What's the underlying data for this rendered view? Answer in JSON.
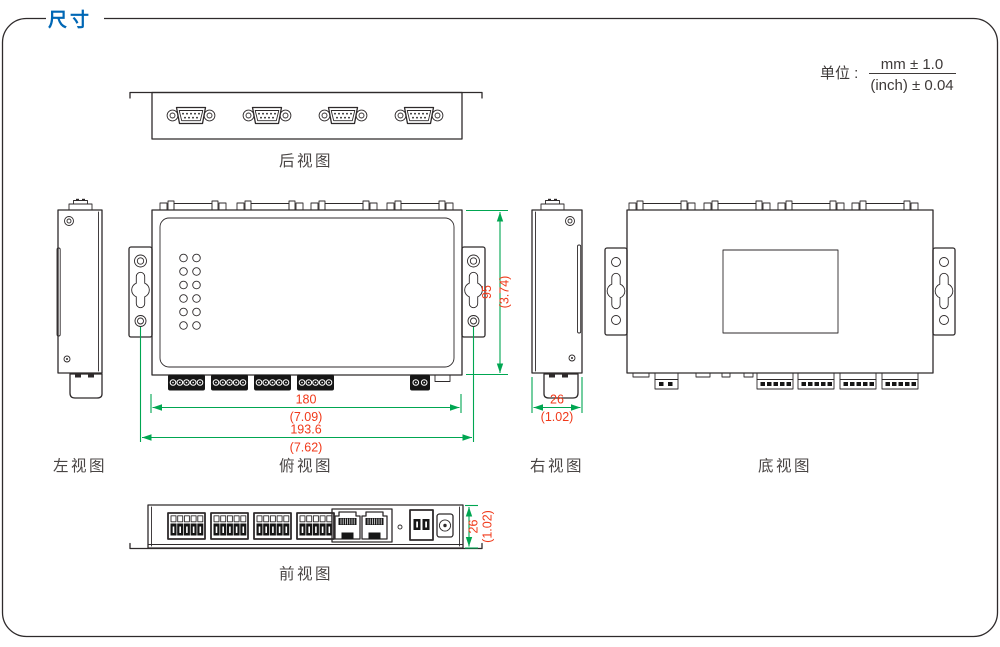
{
  "title": "尺寸",
  "unit": {
    "label": "单位 :",
    "mm": "mm ± 1.0",
    "inch": "(inch) ± 0.04"
  },
  "views": {
    "rear": "后视图",
    "left": "左视图",
    "top": "俯视图",
    "right": "右视图",
    "bottom": "底视图",
    "front": "前视图"
  },
  "dims": {
    "w_mm": "180",
    "w_in": "(7.09)",
    "ow_mm": "193.6",
    "ow_in": "(7.62)",
    "h_mm": "95",
    "h_in": "(3.74)",
    "d_mm": "26",
    "d_in": "(1.02)"
  },
  "colors": {
    "accent_blue": "#0067b5",
    "dim_line_green": "#00a651",
    "dim_text_red": "#f0391a",
    "line_art": "#2e2a2b",
    "label_gray": "#494544"
  }
}
